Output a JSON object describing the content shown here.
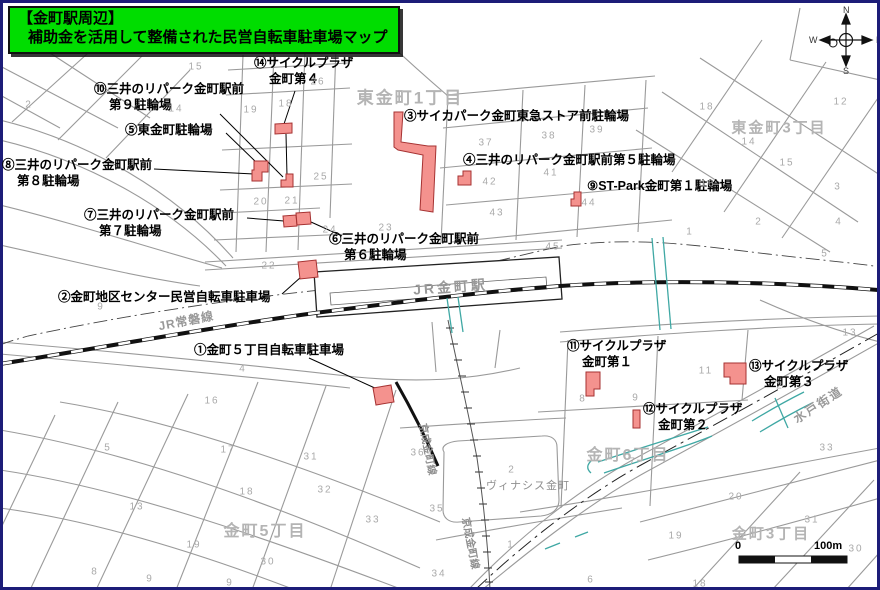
{
  "title": {
    "line1": "【金町駅周辺】",
    "line2": "補助金を活用して整備された民営自転車駐車場マップ"
  },
  "labels": {
    "station": "JR金町駅",
    "joban": "JR常磐線",
    "keisei": "京成金町線",
    "mito": "水戸街道",
    "vinacis": "ヴィナシス金町"
  },
  "compass": {
    "n": "N",
    "e": "E",
    "w": "W",
    "s": "S"
  },
  "scale": {
    "zero": "0",
    "hundred": "100m"
  },
  "colors": {
    "marker": "#f4928e",
    "marker_border": "#a63232",
    "title_bg": "#00dd00",
    "frame": "#1d1d78",
    "teal": "#3fa8a4"
  },
  "map": {
    "areas": [
      {
        "label": "東金町1丁目",
        "x": 410,
        "y": 96,
        "size": 17
      },
      {
        "label": "東金町3丁目",
        "x": 779,
        "y": 127,
        "size": 15
      },
      {
        "label": "金町6丁目",
        "x": 628,
        "y": 453,
        "size": 16
      },
      {
        "label": "金町5丁目",
        "x": 265,
        "y": 529,
        "size": 16
      },
      {
        "label": "金町3丁目",
        "x": 771,
        "y": 533,
        "size": 15
      }
    ],
    "facilities": [
      {
        "id": "1",
        "x": 194,
        "y": 342,
        "lines": [
          "①金町５丁目自転車駐車場"
        ]
      },
      {
        "id": "2",
        "x": 58,
        "y": 289,
        "lines": [
          "②金町地区センター民営自転車駐車場"
        ]
      },
      {
        "id": "3",
        "x": 404,
        "y": 108,
        "lines": [
          "③サイカパーク金町東急ストア前駐輪場"
        ]
      },
      {
        "id": "4",
        "x": 463,
        "y": 152,
        "lines": [
          "④三井のリパーク金町駅前第５駐輪場"
        ]
      },
      {
        "id": "5",
        "x": 125,
        "y": 122,
        "lines": [
          "⑤東金町駐輪場"
        ]
      },
      {
        "id": "6",
        "x": 329,
        "y": 231,
        "lines": [
          "⑥三井のリパーク金町駅前",
          "第６駐輪場"
        ]
      },
      {
        "id": "7",
        "x": 84,
        "y": 207,
        "lines": [
          "⑦三井のリパーク金町駅前",
          "第７駐輪場"
        ]
      },
      {
        "id": "8",
        "x": 2,
        "y": 157,
        "lines": [
          "⑧三井のリパーク金町駅前",
          "第８駐輪場"
        ]
      },
      {
        "id": "9",
        "x": 587,
        "y": 178,
        "lines": [
          "⑨ST-Park金町第１駐輪場"
        ]
      },
      {
        "id": "10",
        "x": 94,
        "y": 81,
        "lines": [
          "⑩三井のリパーク金町駅前",
          "第９駐輪場"
        ]
      },
      {
        "id": "11",
        "x": 567,
        "y": 338,
        "lines": [
          "⑪サイクルプラザ",
          "金町第１"
        ]
      },
      {
        "id": "12",
        "x": 643,
        "y": 401,
        "lines": [
          "⑫サイクルプラザ",
          "金町第２"
        ]
      },
      {
        "id": "13",
        "x": 749,
        "y": 358,
        "lines": [
          "⑬サイクルプラザ",
          "金町第３"
        ]
      },
      {
        "id": "14",
        "x": 254,
        "y": 55,
        "lines": [
          "⑭サイクルプラザ",
          "金町第４"
        ]
      }
    ],
    "blocks": [
      {
        "t": "15",
        "x": 196,
        "y": 67
      },
      {
        "t": "2",
        "x": 29,
        "y": 105
      },
      {
        "t": "14",
        "x": 176,
        "y": 109
      },
      {
        "t": "19",
        "x": 251,
        "y": 110
      },
      {
        "t": "18",
        "x": 286,
        "y": 104
      },
      {
        "t": "26",
        "x": 318,
        "y": 82
      },
      {
        "t": "25",
        "x": 321,
        "y": 177
      },
      {
        "t": "20",
        "x": 261,
        "y": 202
      },
      {
        "t": "21",
        "x": 292,
        "y": 201
      },
      {
        "t": "24",
        "x": 330,
        "y": 230
      },
      {
        "t": "22",
        "x": 269,
        "y": 266
      },
      {
        "t": "23",
        "x": 386,
        "y": 228
      },
      {
        "t": "37",
        "x": 486,
        "y": 143
      },
      {
        "t": "38",
        "x": 549,
        "y": 136
      },
      {
        "t": "39",
        "x": 597,
        "y": 130
      },
      {
        "t": "42",
        "x": 490,
        "y": 182
      },
      {
        "t": "41",
        "x": 551,
        "y": 173
      },
      {
        "t": "43",
        "x": 497,
        "y": 213
      },
      {
        "t": "44",
        "x": 589,
        "y": 203
      },
      {
        "t": "45",
        "x": 553,
        "y": 247
      },
      {
        "t": "18",
        "x": 707,
        "y": 107
      },
      {
        "t": "12",
        "x": 841,
        "y": 102
      },
      {
        "t": "14",
        "x": 749,
        "y": 142
      },
      {
        "t": "15",
        "x": 787,
        "y": 163
      },
      {
        "t": "16",
        "x": 708,
        "y": 184
      },
      {
        "t": "2",
        "x": 759,
        "y": 222
      },
      {
        "t": "3",
        "x": 838,
        "y": 187
      },
      {
        "t": "4",
        "x": 839,
        "y": 222
      },
      {
        "t": "5",
        "x": 825,
        "y": 254
      },
      {
        "t": "1",
        "x": 690,
        "y": 232
      },
      {
        "t": "13",
        "x": 850,
        "y": 333
      },
      {
        "t": "9",
        "x": 101,
        "y": 307
      },
      {
        "t": "4",
        "x": 243,
        "y": 369
      },
      {
        "t": "16",
        "x": 212,
        "y": 401
      },
      {
        "t": "17",
        "x": 228,
        "y": 450
      },
      {
        "t": "5",
        "x": 108,
        "y": 448
      },
      {
        "t": "13",
        "x": 137,
        "y": 507
      },
      {
        "t": "18",
        "x": 247,
        "y": 492
      },
      {
        "t": "31",
        "x": 311,
        "y": 457
      },
      {
        "t": "32",
        "x": 325,
        "y": 490
      },
      {
        "t": "33",
        "x": 373,
        "y": 520
      },
      {
        "t": "19",
        "x": 194,
        "y": 545
      },
      {
        "t": "30",
        "x": 268,
        "y": 562
      },
      {
        "t": "8",
        "x": 95,
        "y": 572
      },
      {
        "t": "9",
        "x": 150,
        "y": 579
      },
      {
        "t": "9",
        "x": 230,
        "y": 583
      },
      {
        "t": "36",
        "x": 418,
        "y": 453
      },
      {
        "t": "35",
        "x": 437,
        "y": 509
      },
      {
        "t": "34",
        "x": 439,
        "y": 574
      },
      {
        "t": "2",
        "x": 512,
        "y": 470
      },
      {
        "t": "1",
        "x": 511,
        "y": 545
      },
      {
        "t": "6",
        "x": 591,
        "y": 580
      },
      {
        "t": "7",
        "x": 633,
        "y": 462
      },
      {
        "t": "8",
        "x": 583,
        "y": 399
      },
      {
        "t": "9",
        "x": 636,
        "y": 398
      },
      {
        "t": "11",
        "x": 706,
        "y": 371
      },
      {
        "t": "2",
        "x": 780,
        "y": 386
      },
      {
        "t": "33",
        "x": 827,
        "y": 448
      },
      {
        "t": "19",
        "x": 676,
        "y": 536
      },
      {
        "t": "20",
        "x": 736,
        "y": 497
      },
      {
        "t": "31",
        "x": 812,
        "y": 520
      },
      {
        "t": "30",
        "x": 856,
        "y": 549
      },
      {
        "t": "18",
        "x": 700,
        "y": 584
      }
    ]
  }
}
